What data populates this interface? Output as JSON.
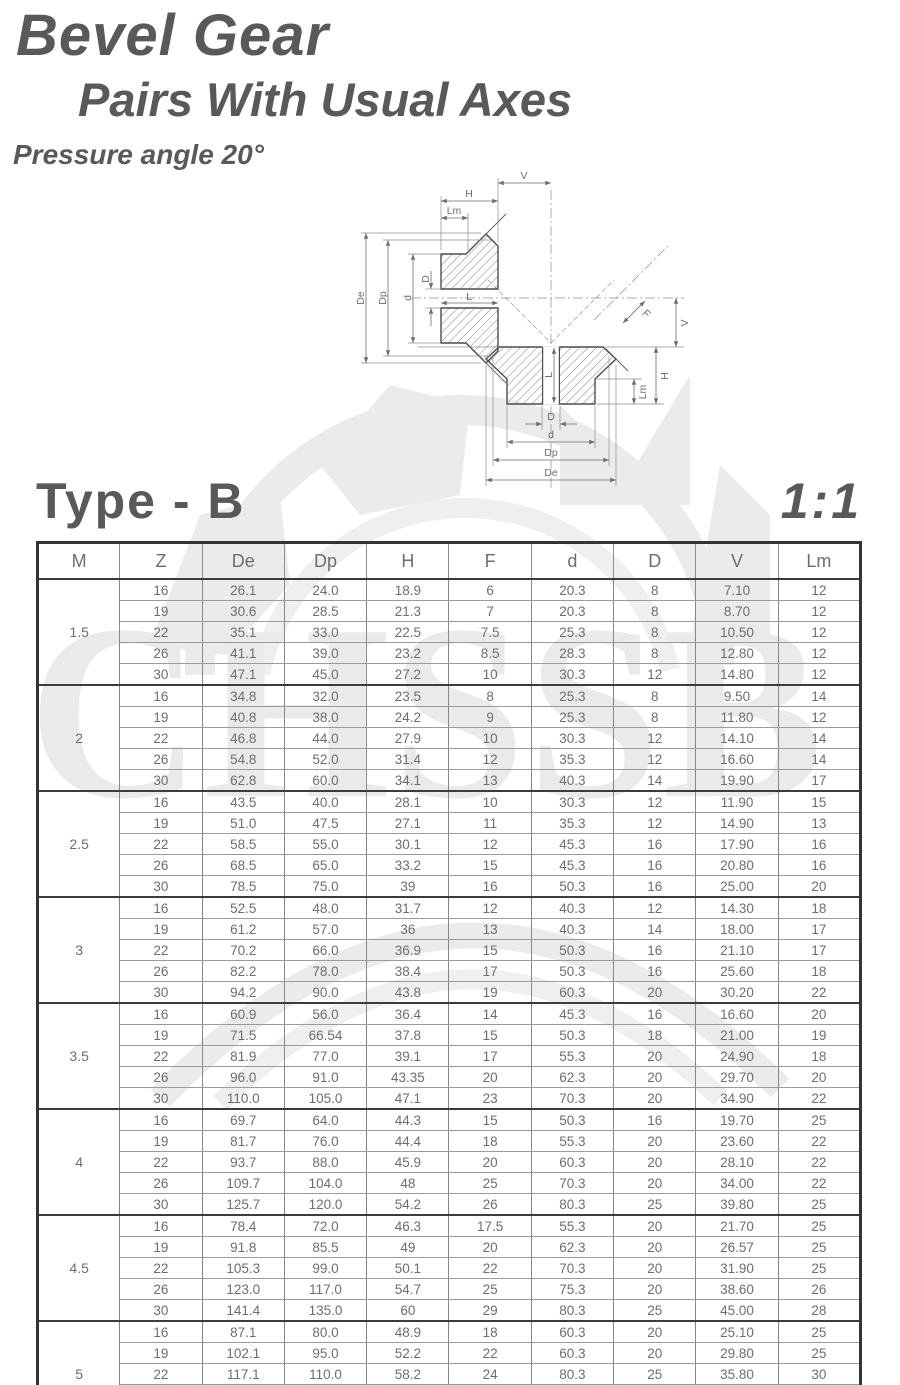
{
  "colors": {
    "title_text": "#58595b",
    "table_text": "#6d6e71",
    "border_dark": "#333436",
    "watermark": "#e9eaeb"
  },
  "header": {
    "title_line1": "Bevel Gear",
    "title_line2": "Pairs With Usual Axes",
    "pressure_angle": "Pressure angle 20°"
  },
  "section": {
    "type_label": "Type - B",
    "ratio_label": "1:1"
  },
  "watermark": {
    "text": "CHSSB"
  },
  "diagram": {
    "labels": {
      "V": "V",
      "H": "H",
      "Lm": "Lm",
      "De": "De",
      "Dp": "Dp",
      "d": "d",
      "D": "D",
      "L": "L",
      "F": "F"
    }
  },
  "table": {
    "columns": [
      "M",
      "Z",
      "De",
      "Dp",
      "H",
      "F",
      "d",
      "D",
      "V",
      "Lm"
    ],
    "groups": [
      {
        "m": "1.5",
        "rows": [
          [
            "16",
            "26.1",
            "24.0",
            "18.9",
            "6",
            "20.3",
            "8",
            "7.10",
            "12"
          ],
          [
            "19",
            "30.6",
            "28.5",
            "21.3",
            "7",
            "20.3",
            "8",
            "8.70",
            "12"
          ],
          [
            "22",
            "35.1",
            "33.0",
            "22.5",
            "7.5",
            "25.3",
            "8",
            "10.50",
            "12"
          ],
          [
            "26",
            "41.1",
            "39.0",
            "23.2",
            "8.5",
            "28.3",
            "8",
            "12.80",
            "12"
          ],
          [
            "30",
            "47.1",
            "45.0",
            "27.2",
            "10",
            "30.3",
            "12",
            "14.80",
            "12"
          ]
        ]
      },
      {
        "m": "2",
        "rows": [
          [
            "16",
            "34.8",
            "32.0",
            "23.5",
            "8",
            "25.3",
            "8",
            "9.50",
            "14"
          ],
          [
            "19",
            "40.8",
            "38.0",
            "24.2",
            "9",
            "25.3",
            "8",
            "11.80",
            "12"
          ],
          [
            "22",
            "46.8",
            "44.0",
            "27.9",
            "10",
            "30.3",
            "12",
            "14.10",
            "14"
          ],
          [
            "26",
            "54.8",
            "52.0",
            "31.4",
            "12",
            "35.3",
            "12",
            "16.60",
            "14"
          ],
          [
            "30",
            "62.8",
            "60.0",
            "34.1",
            "13",
            "40.3",
            "14",
            "19.90",
            "17"
          ]
        ]
      },
      {
        "m": "2.5",
        "rows": [
          [
            "16",
            "43.5",
            "40.0",
            "28.1",
            "10",
            "30.3",
            "12",
            "11.90",
            "15"
          ],
          [
            "19",
            "51.0",
            "47.5",
            "27.1",
            "11",
            "35.3",
            "12",
            "14.90",
            "13"
          ],
          [
            "22",
            "58.5",
            "55.0",
            "30.1",
            "12",
            "45.3",
            "16",
            "17.90",
            "16"
          ],
          [
            "26",
            "68.5",
            "65.0",
            "33.2",
            "15",
            "45.3",
            "16",
            "20.80",
            "16"
          ],
          [
            "30",
            "78.5",
            "75.0",
            "39",
            "16",
            "50.3",
            "16",
            "25.00",
            "20"
          ]
        ]
      },
      {
        "m": "3",
        "rows": [
          [
            "16",
            "52.5",
            "48.0",
            "31.7",
            "12",
            "40.3",
            "12",
            "14.30",
            "18"
          ],
          [
            "19",
            "61.2",
            "57.0",
            "36",
            "13",
            "40.3",
            "14",
            "18.00",
            "17"
          ],
          [
            "22",
            "70.2",
            "66.0",
            "36.9",
            "15",
            "50.3",
            "16",
            "21.10",
            "17"
          ],
          [
            "26",
            "82.2",
            "78.0",
            "38.4",
            "17",
            "50.3",
            "16",
            "25.60",
            "18"
          ],
          [
            "30",
            "94.2",
            "90.0",
            "43.8",
            "19",
            "60.3",
            "20",
            "30.20",
            "22"
          ]
        ]
      },
      {
        "m": "3.5",
        "rows": [
          [
            "16",
            "60.9",
            "56.0",
            "36.4",
            "14",
            "45.3",
            "16",
            "16.60",
            "20"
          ],
          [
            "19",
            "71.5",
            "66.54",
            "37.8",
            "15",
            "50.3",
            "18",
            "21.00",
            "19"
          ],
          [
            "22",
            "81.9",
            "77.0",
            "39.1",
            "17",
            "55.3",
            "20",
            "24.90",
            "18"
          ],
          [
            "26",
            "96.0",
            "91.0",
            "43.35",
            "20",
            "62.3",
            "20",
            "29.70",
            "20"
          ],
          [
            "30",
            "110.0",
            "105.0",
            "47.1",
            "23",
            "70.3",
            "20",
            "34.90",
            "22"
          ]
        ]
      },
      {
        "m": "4",
        "rows": [
          [
            "16",
            "69.7",
            "64.0",
            "44.3",
            "15",
            "50.3",
            "16",
            "19.70",
            "25"
          ],
          [
            "19",
            "81.7",
            "76.0",
            "44.4",
            "18",
            "55.3",
            "20",
            "23.60",
            "22"
          ],
          [
            "22",
            "93.7",
            "88.0",
            "45.9",
            "20",
            "60.3",
            "20",
            "28.10",
            "22"
          ],
          [
            "26",
            "109.7",
            "104.0",
            "48",
            "25",
            "70.3",
            "20",
            "34.00",
            "22"
          ],
          [
            "30",
            "125.7",
            "120.0",
            "54.2",
            "26",
            "80.3",
            "25",
            "39.80",
            "25"
          ]
        ]
      },
      {
        "m": "4.5",
        "rows": [
          [
            "16",
            "78.4",
            "72.0",
            "46.3",
            "17.5",
            "55.3",
            "20",
            "21.70",
            "25"
          ],
          [
            "19",
            "91.8",
            "85.5",
            "49",
            "20",
            "62.3",
            "20",
            "26.57",
            "25"
          ],
          [
            "22",
            "105.3",
            "99.0",
            "50.1",
            "22",
            "70.3",
            "20",
            "31.90",
            "25"
          ],
          [
            "26",
            "123.0",
            "117.0",
            "54.7",
            "25",
            "75.3",
            "20",
            "38.60",
            "26"
          ],
          [
            "30",
            "141.4",
            "135.0",
            "60",
            "29",
            "80.3",
            "25",
            "45.00",
            "28"
          ]
        ]
      },
      {
        "m": "5",
        "rows": [
          [
            "16",
            "87.1",
            "80.0",
            "48.9",
            "18",
            "60.3",
            "20",
            "25.10",
            "25"
          ],
          [
            "19",
            "102.1",
            "95.0",
            "52.2",
            "22",
            "60.3",
            "20",
            "29.80",
            "25"
          ],
          [
            "22",
            "117.1",
            "110.0",
            "58.2",
            "24",
            "80.3",
            "25",
            "35.80",
            "30"
          ],
          [
            "26",
            "137.1",
            "130.0",
            "62.7",
            "29",
            "80.3",
            "25",
            "42.30",
            "30"
          ],
          [
            "30",
            "157.1",
            "150.0",
            "68.9",
            "32",
            "80.3",
            "30",
            "50.10",
            "35"
          ]
        ]
      }
    ]
  }
}
